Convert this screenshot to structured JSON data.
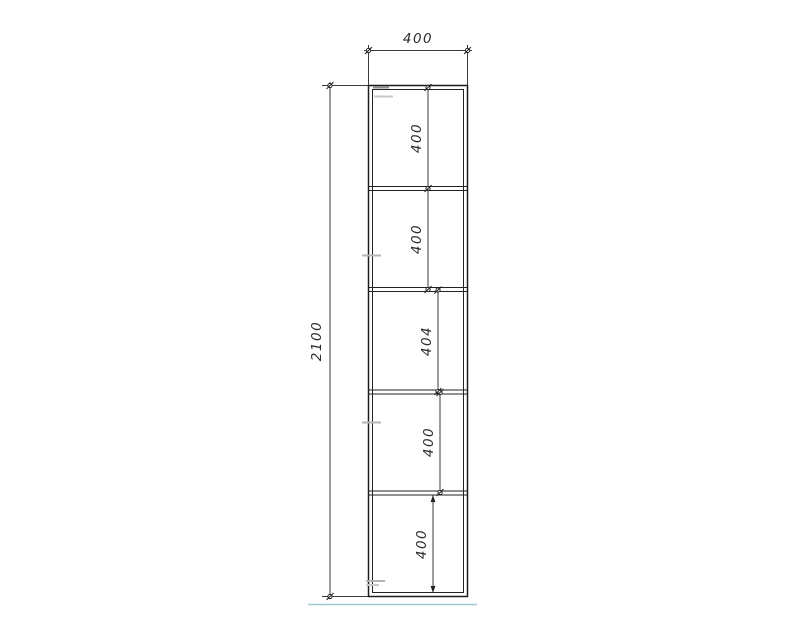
{
  "drawing": {
    "type": "furniture-elevation",
    "overall_dimensions": {
      "width_label": "400",
      "height_label": "2100"
    },
    "compartments": [
      {
        "label": "400"
      },
      {
        "label": "400"
      },
      {
        "label": "404"
      },
      {
        "label": "400"
      },
      {
        "label": "400"
      }
    ],
    "colors": {
      "line": "#222222",
      "dimension_line": "#3a3a3a",
      "text": "#2e2e2e",
      "floor_line": "#9ec9d2",
      "marks": "#b4b4b4",
      "background": "#ffffff"
    }
  }
}
